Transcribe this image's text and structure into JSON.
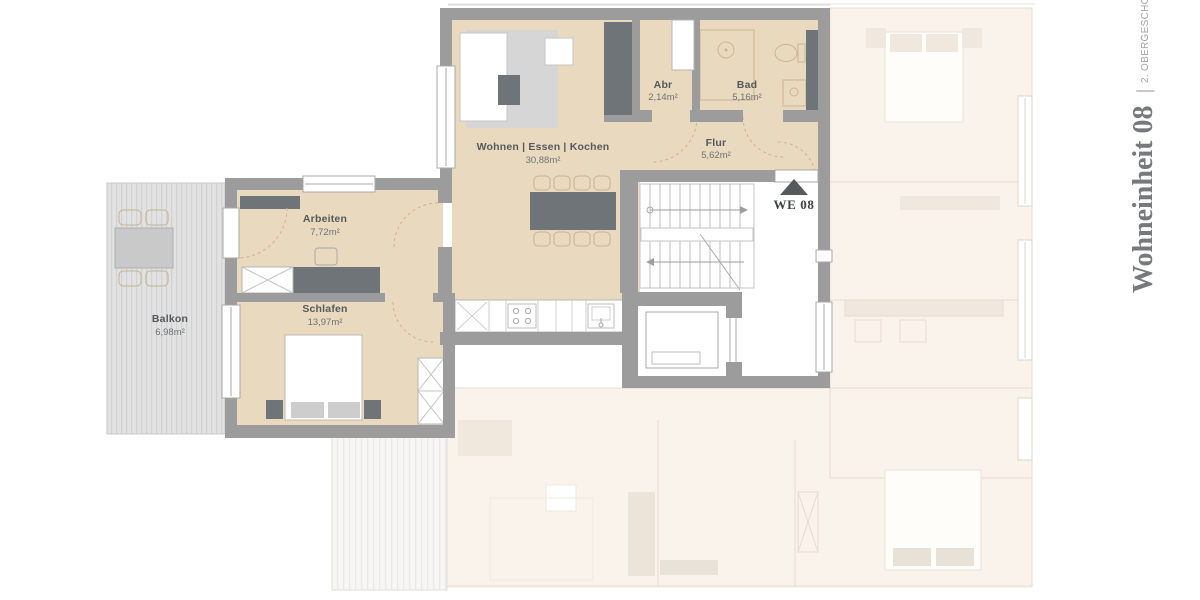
{
  "title": {
    "unit": "Wohneinheit 08",
    "separator": "|",
    "floor": "2. OBERGESCHOSS"
  },
  "unit_marker": {
    "label": "WE 08",
    "icon": "triangle-up-icon"
  },
  "rooms": {
    "wohnen": {
      "name": "Wohnen | Essen | Kochen",
      "area": "30,88m²"
    },
    "abr": {
      "name": "Abr",
      "area": "2,14m²"
    },
    "bad": {
      "name": "Bad",
      "area": "5,16m²"
    },
    "flur": {
      "name": "Flur",
      "area": "5,62m²"
    },
    "arbeiten": {
      "name": "Arbeiten",
      "area": "7,72m²"
    },
    "schlafen": {
      "name": "Schlafen",
      "area": "13,97m²"
    },
    "balkon": {
      "name": "Balkon",
      "area": "6,98m²"
    }
  },
  "colors": {
    "floor_active": "#e9dabf",
    "wall": "#9c9c9c",
    "furniture_dark": "#6f7478",
    "rug": "#d6d6d6",
    "ghost_floor": "#faf3ec",
    "label_text": "#55595c"
  }
}
